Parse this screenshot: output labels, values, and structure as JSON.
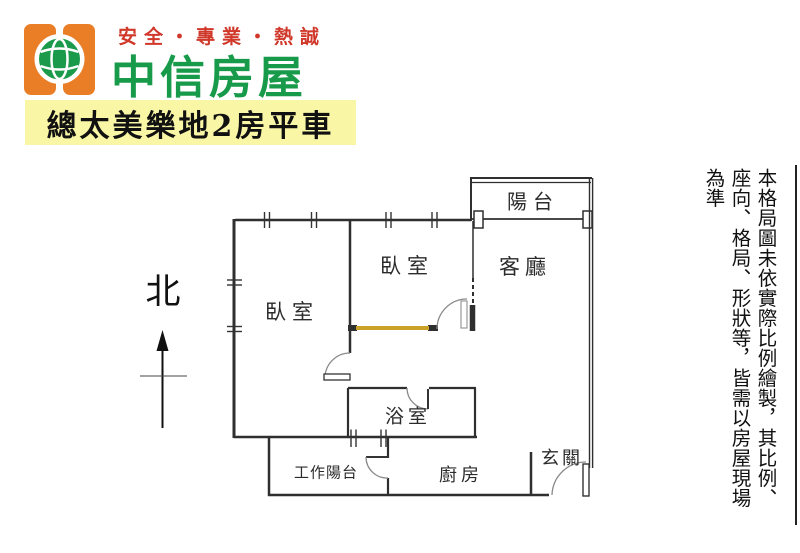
{
  "brand": {
    "tagline": "安全・專業・熱誠",
    "name": "中信房屋",
    "tagline_color": "#d0382a",
    "name_color": "#179a49",
    "logo_orange": "#e97e26",
    "logo_green": "#1a9a4a"
  },
  "listing_banner": {
    "text": "總太美樂地2房平車",
    "bg_color": "#f9f6a6"
  },
  "compass": {
    "label": "北"
  },
  "floorplan": {
    "accent_wall_color": "#c9a227",
    "rooms": [
      {
        "id": "balcony",
        "label": "陽台"
      },
      {
        "id": "living-room",
        "label": "客廳"
      },
      {
        "id": "bedroom-middle",
        "label": "臥室"
      },
      {
        "id": "bedroom-left",
        "label": "臥室"
      },
      {
        "id": "bathroom",
        "label": "浴室"
      },
      {
        "id": "utility-balcony",
        "label": "工作陽台"
      },
      {
        "id": "kitchen",
        "label": "廚房"
      },
      {
        "id": "entryway",
        "label": "玄關"
      }
    ]
  },
  "disclaimer": {
    "text": "本格局圖未依實際比例繪製，其比例、座向、格局、形狀等，皆需以房屋現場為準"
  }
}
